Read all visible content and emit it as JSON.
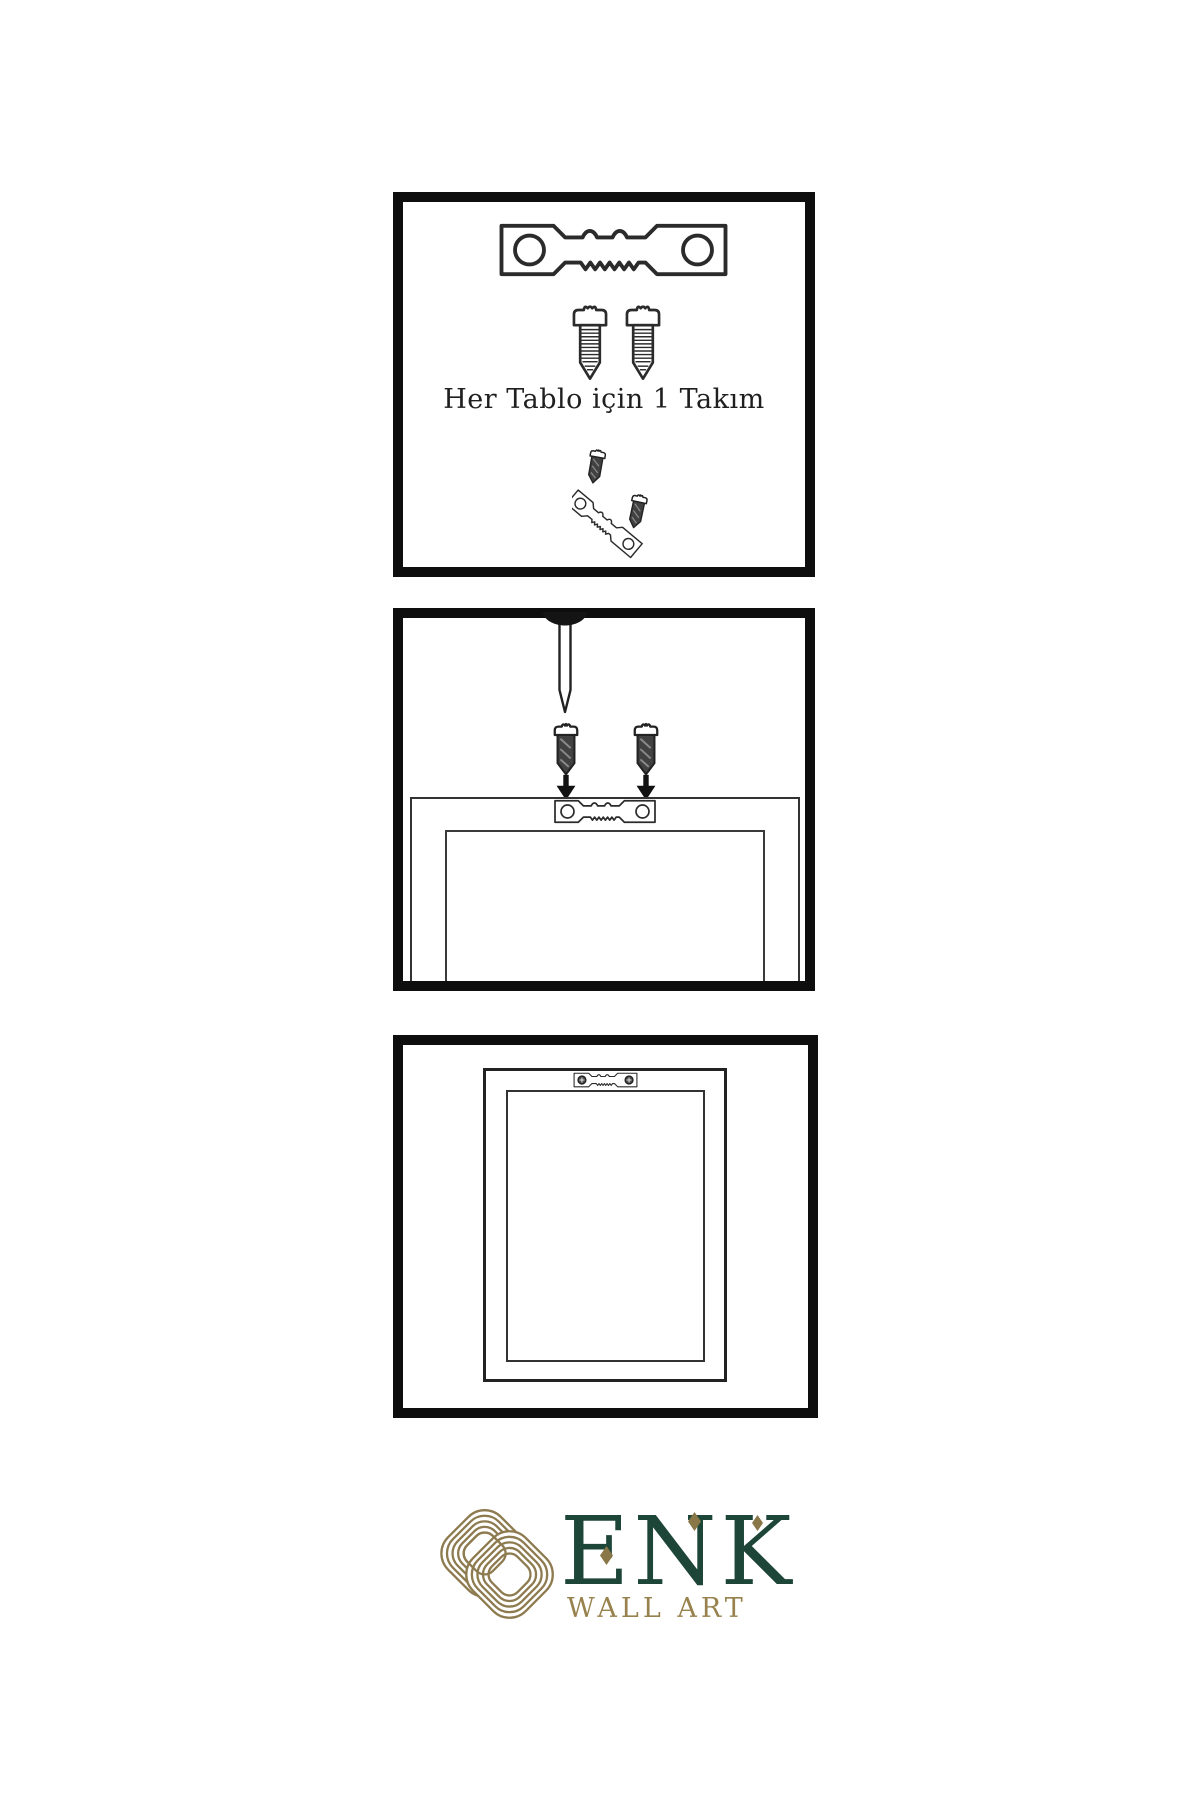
{
  "instructions": {
    "step1_caption": "Her Tablo için 1 Takım"
  },
  "logo": {
    "brand": "ENK",
    "subtitle": "WALL ART"
  },
  "icons": {
    "sawtooth-hanger-icon": "svg outline plate with two holes and zigzag teeth",
    "screw-icon": "svg outlined screw with threaded shaft",
    "dark-screw-icon": "svg dark-filled short screw",
    "down-arrow-icon": "svg solid black down arrow",
    "nail-icon": "svg nail with dark head embedded in top border",
    "phillips-screw-head-icon": "dark circle with cross",
    "frame-back-outline": "nested rectangles, back of picture frame",
    "frame-front-outline": "nested rectangles, hung picture frame",
    "knot-logo-icon": "gold concentric interlaced knot",
    "diamond-accent-icon": "small gold diamond"
  },
  "colors": {
    "background": "#ffffff",
    "panel_border": "#0e0e0e",
    "line_art": "#2b2b2b",
    "dark_fill": "#414141",
    "text": "#1f1f1f",
    "logo_gold": "#8d7b4f",
    "logo_green": "#1d4538",
    "subtitle_gold": "#97824d"
  }
}
